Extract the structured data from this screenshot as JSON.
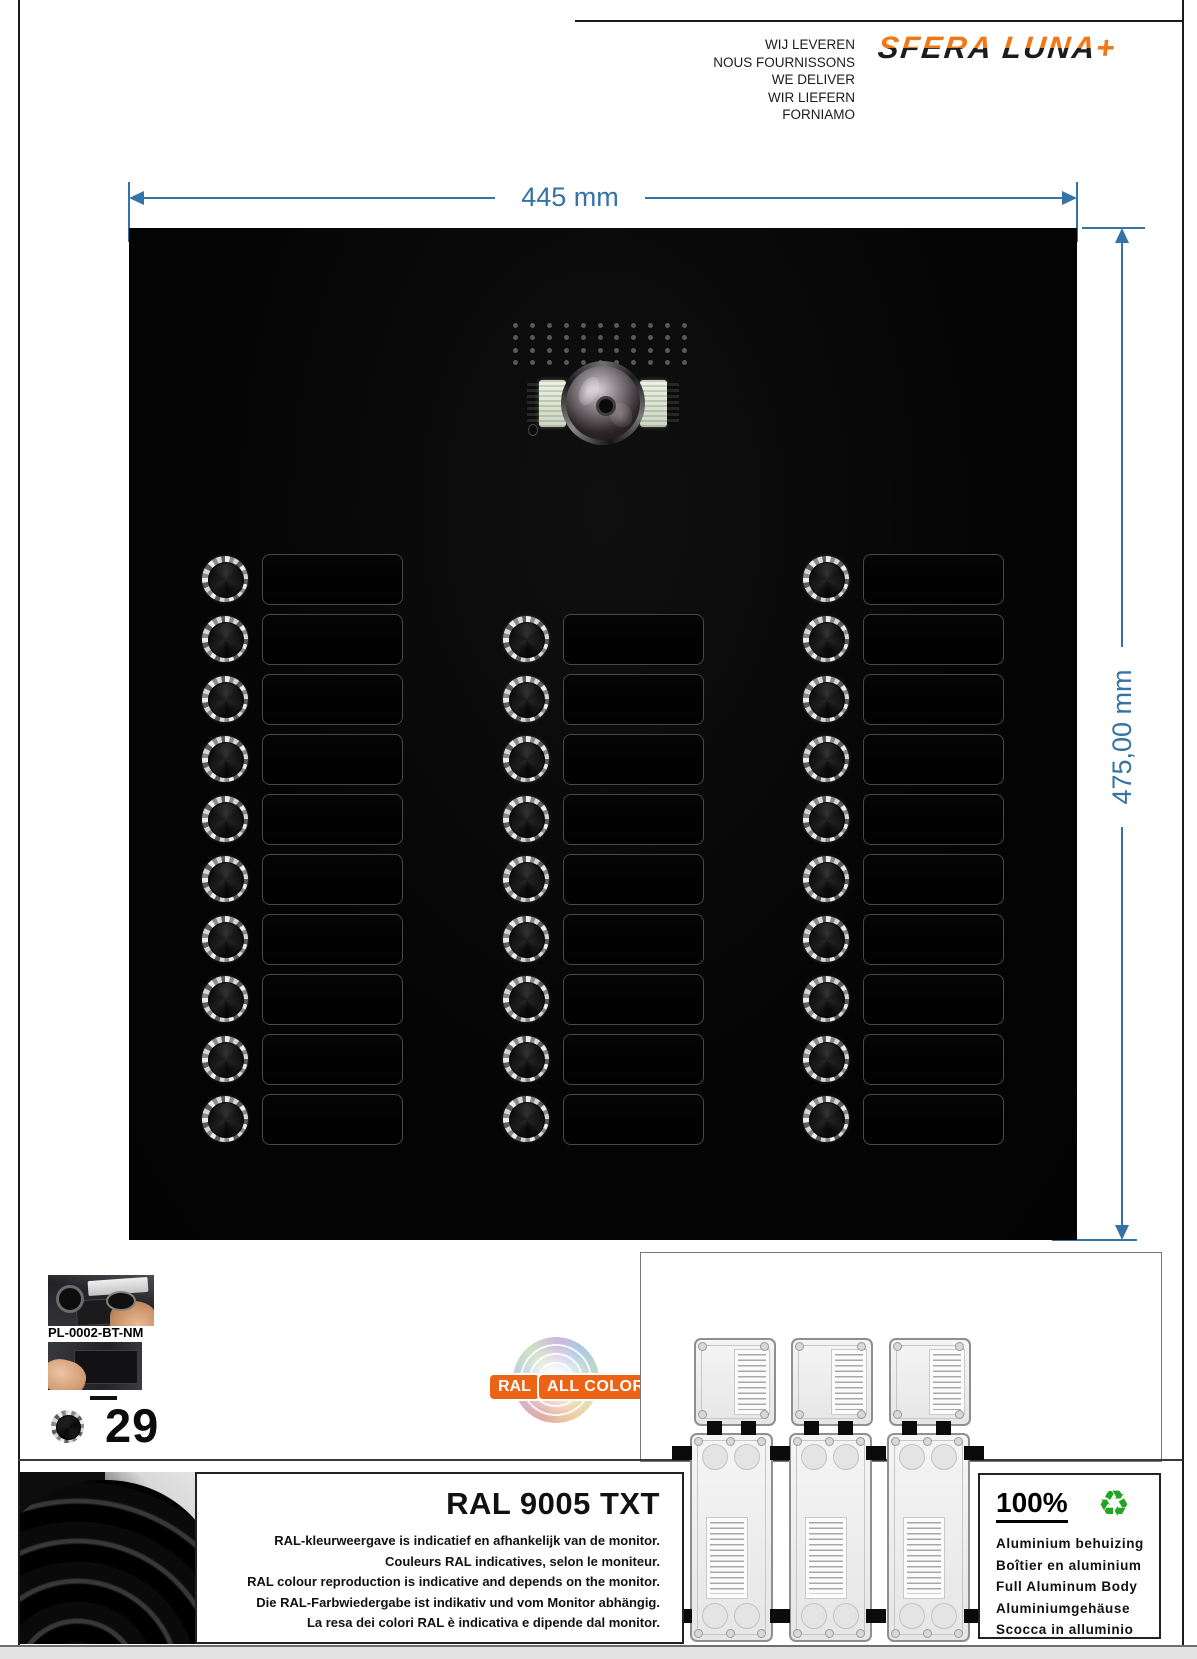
{
  "header": {
    "languages": [
      "WIJ LEVEREN",
      "NOUS FOURNISSONS",
      "WE DELIVER",
      "WIR LIEFERN",
      "FORNIAMO"
    ],
    "logo_text": "SFERA LUNA",
    "logo_plus": "+",
    "logo_orange": "#f07818"
  },
  "dimensions": {
    "width_label": "445 mm",
    "height_label": "475,00 mm",
    "line_color": "#3572a5"
  },
  "panel": {
    "rows": 10,
    "row_pitch": 60,
    "first_row_y": 351,
    "button_diameter": 46,
    "columns": [
      {
        "cx": 96,
        "start_row": 0,
        "count": 10
      },
      {
        "cx": 397,
        "start_row": 1,
        "count": 9
      },
      {
        "cx": 697,
        "start_row": 0,
        "count": 10
      }
    ],
    "plate_offset_x": 37,
    "plate_width": 139,
    "plate_height": 49,
    "speaker_grille": {
      "rows": 4,
      "cols": 11
    },
    "total_buttons": 29
  },
  "products": {
    "code": "PL-0002-BT-NM",
    "button_count": "29"
  },
  "ral_logo": {
    "ral": "RAL",
    "all_colors": "ALL COLORS",
    "orange": "#ec6316"
  },
  "mounting": {
    "small_boxes": 3,
    "tall_boxes": 3
  },
  "ral_box": {
    "title": "RAL 9005 TXT",
    "lines": [
      "RAL-kleurweergave is indicatief en afhankelijk van de monitor.",
      "Couleurs RAL indicatives, selon le moniteur.",
      "RAL colour reproduction is indicative and depends on the monitor.",
      "Die RAL-Farbwiedergabe ist indikativ und vom Monitor abhängig.",
      "La resa dei colori RAL è indicativa e dipende dal monitor."
    ]
  },
  "recycle_box": {
    "percent": "100%",
    "icon": "♻",
    "icon_color": "#22a522",
    "lines": [
      "Aluminium behuizing",
      "Boîtier en aluminium",
      "Full Aluminum Body",
      "Aluminiumgehäuse",
      "Scocca in alluminio"
    ]
  }
}
